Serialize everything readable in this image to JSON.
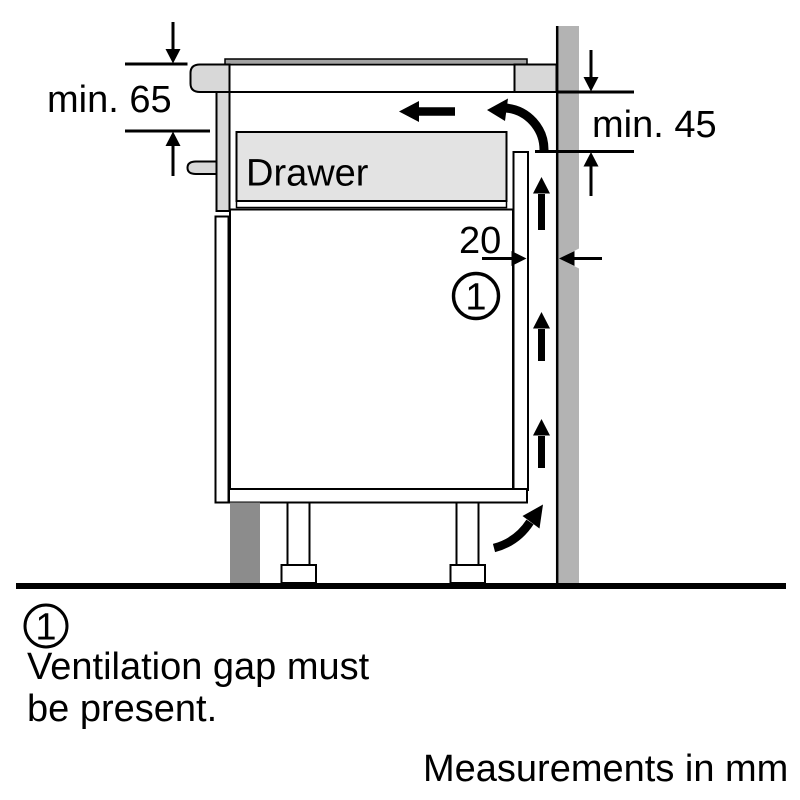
{
  "colors": {
    "ink": "#000000",
    "background": "#ffffff",
    "worktop_gray": "#d8d8d8",
    "drawer_gray": "#e3e3e3",
    "hob_glass_gray": "#a3a3a3",
    "wall_gray": "#b3b3b3",
    "plinth_gray": "#8c8c8c"
  },
  "diagram": {
    "drawer_label": "Drawer",
    "dims": {
      "hob_clearance": "min. 65",
      "wall_clearance": "min. 45",
      "vent_gap": "20"
    },
    "callout_number": "1"
  },
  "note": {
    "number": "1",
    "line1": "Ventilation gap must",
    "line2": "be present."
  },
  "footer": {
    "text": "Measurements in mm"
  }
}
